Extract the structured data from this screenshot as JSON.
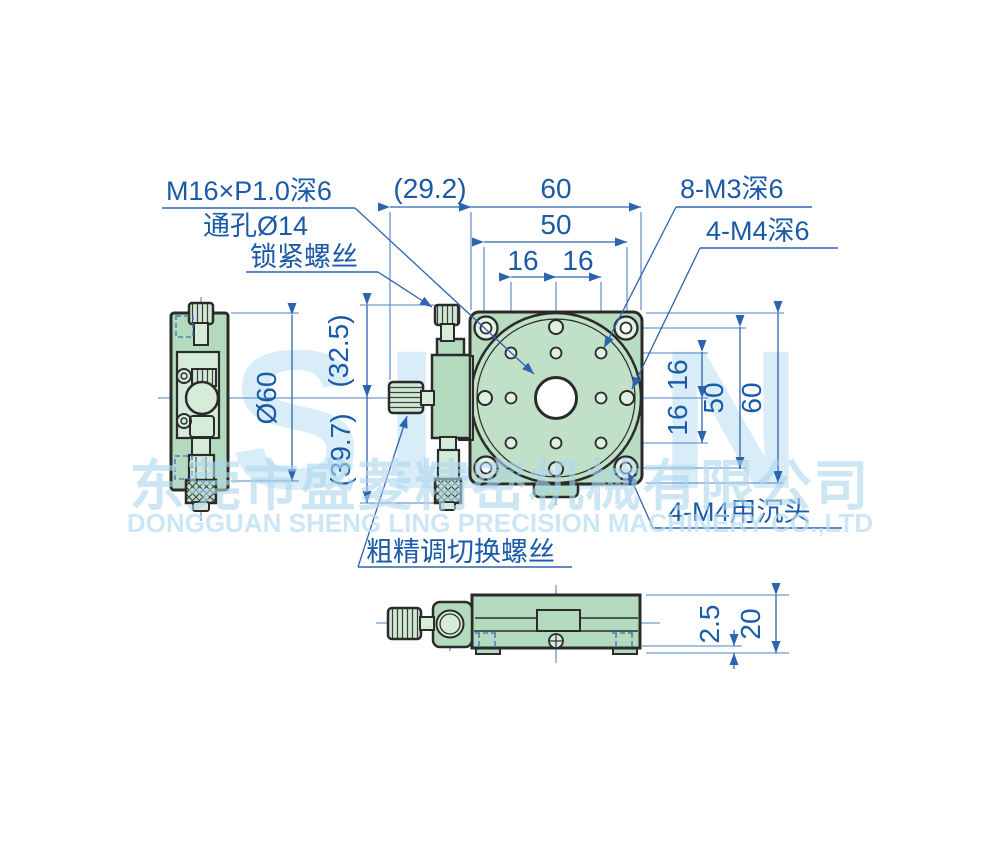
{
  "drawing_title": "rotation-stage-dimension-drawing",
  "watermark": {
    "logo": "SLJN",
    "company_cn": "东莞市盛菱精密机械有限公司",
    "company_en": "DONGGUAN SHENG LING PRECISION MACHINERY CO.,LTD"
  },
  "labels": {
    "thread_spec": "M16×P1.0深6",
    "through_hole": "通孔Ø14",
    "lock_screw": "锁紧螺丝",
    "m3_holes": "8-M3深6",
    "m4_holes": "4-M4深6",
    "m4_counterbore": "4-M4用沉头",
    "coarse_fine_switch": "粗精调切换螺丝"
  },
  "dims": {
    "offset_w": "(29.2)",
    "total_w": "60",
    "bolt_span_w": "50",
    "pitch_w1": "16",
    "pitch_w2": "16",
    "platform_dia": "Ø60",
    "upper_h": "(32.5)",
    "lower_h": "(39.7)",
    "pitch_h1": "16",
    "pitch_h2": "16",
    "bolt_span_h": "50",
    "total_h": "60",
    "base_step": "2.5",
    "base_thickness": "20"
  },
  "colors": {
    "dimension_blue": "#2e63ae",
    "text_blue": "#1a5aa8",
    "part_outline": "#2b2b2b",
    "body_green": "#b4dabe",
    "light_green": "#d6ecda",
    "watermark_blue": "#d9edf8"
  }
}
